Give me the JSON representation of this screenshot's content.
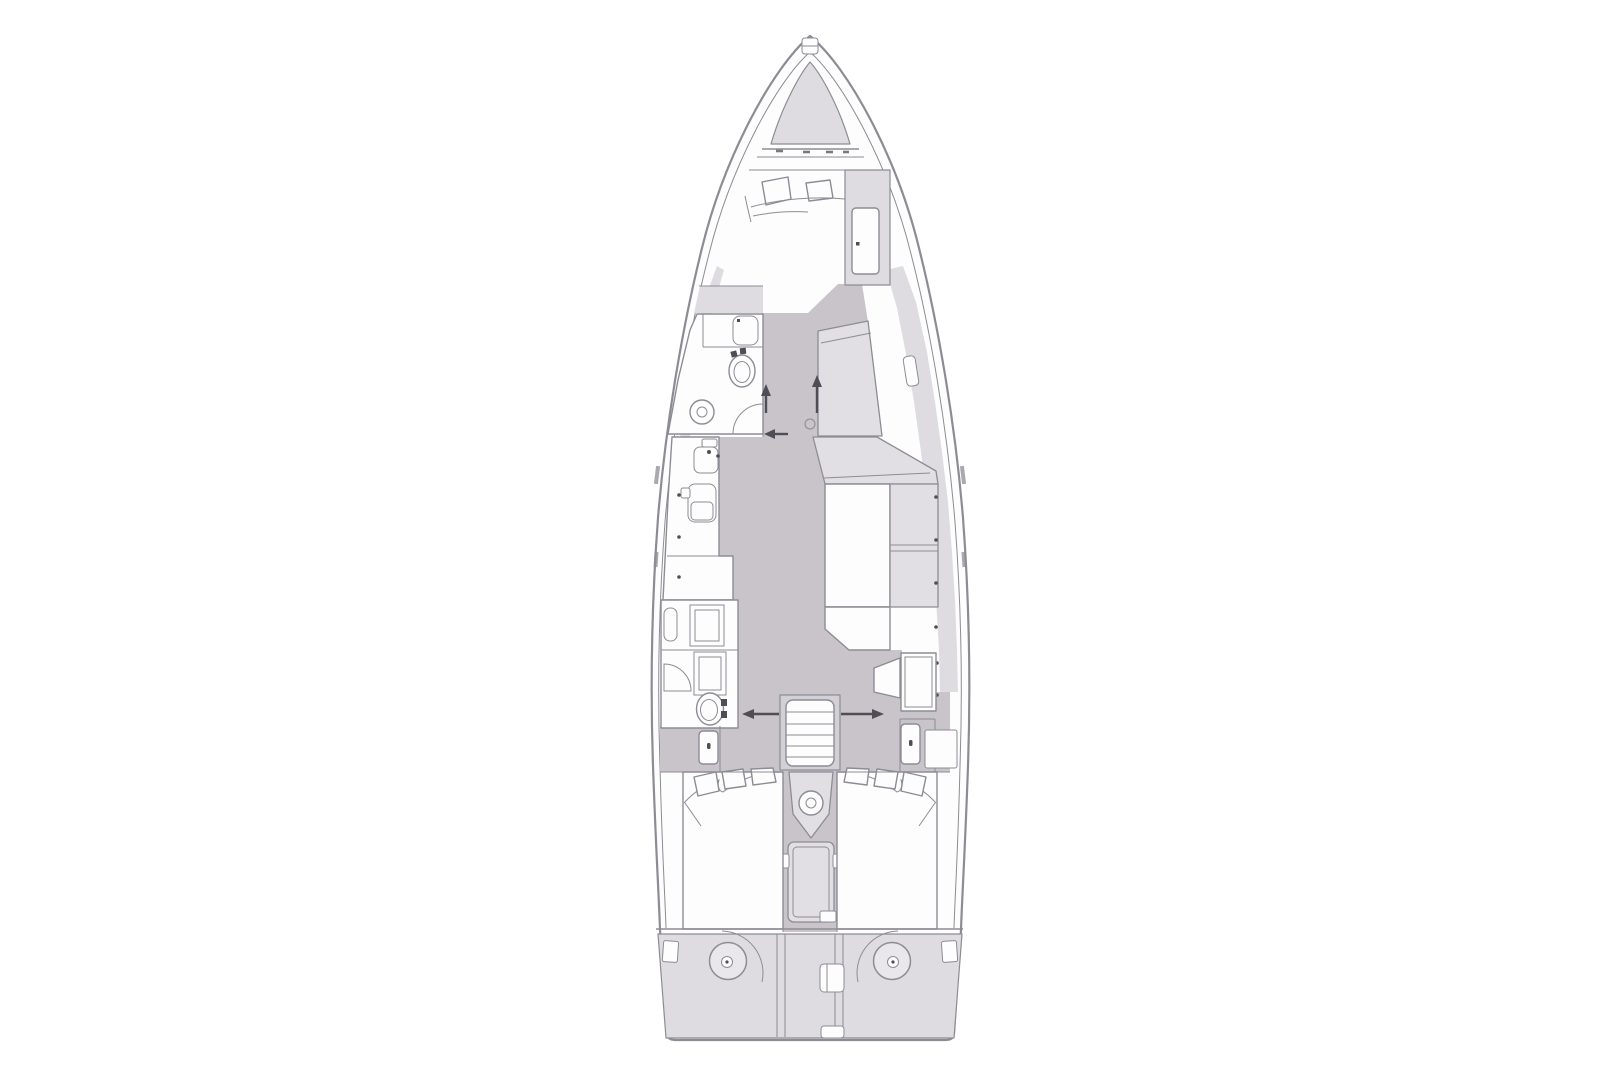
{
  "meta": {
    "title": "Sailing yacht interior layout plan — overhead deck view"
  },
  "palette": {
    "background": "#ffffff",
    "white": "#fdfdfe",
    "line": "#8d8c94",
    "line_dark": "#4f4e57",
    "walkway": "#c8c4ca",
    "deck": "#dfdce1",
    "furniture": "#e2dfe4",
    "frame": "#d2cfd5",
    "circle_fill": "#eae7ec"
  },
  "features": [
    "bow-anchor-locker",
    "v-berth-double-bed",
    "bed-pillows",
    "starboard-hanging-locker",
    "coachroof-window",
    "hull-porthole",
    "forward-head-toilet",
    "forward-head-sink",
    "forward-head-vanity",
    "galley-sink",
    "galley-stove",
    "salon-l-shaped-sofa",
    "salon-chaise",
    "nav-seat-cabinet",
    "mid-head-shower",
    "mid-head-sink",
    "mid-head-toilet",
    "companionway-stairs",
    "engine-compartment",
    "port-aft-double-bed",
    "starboard-aft-double-bed",
    "deck-hatch",
    "steering-gear-port",
    "steering-gear-starboard",
    "transom-platform",
    "walk-direction-arrows"
  ]
}
